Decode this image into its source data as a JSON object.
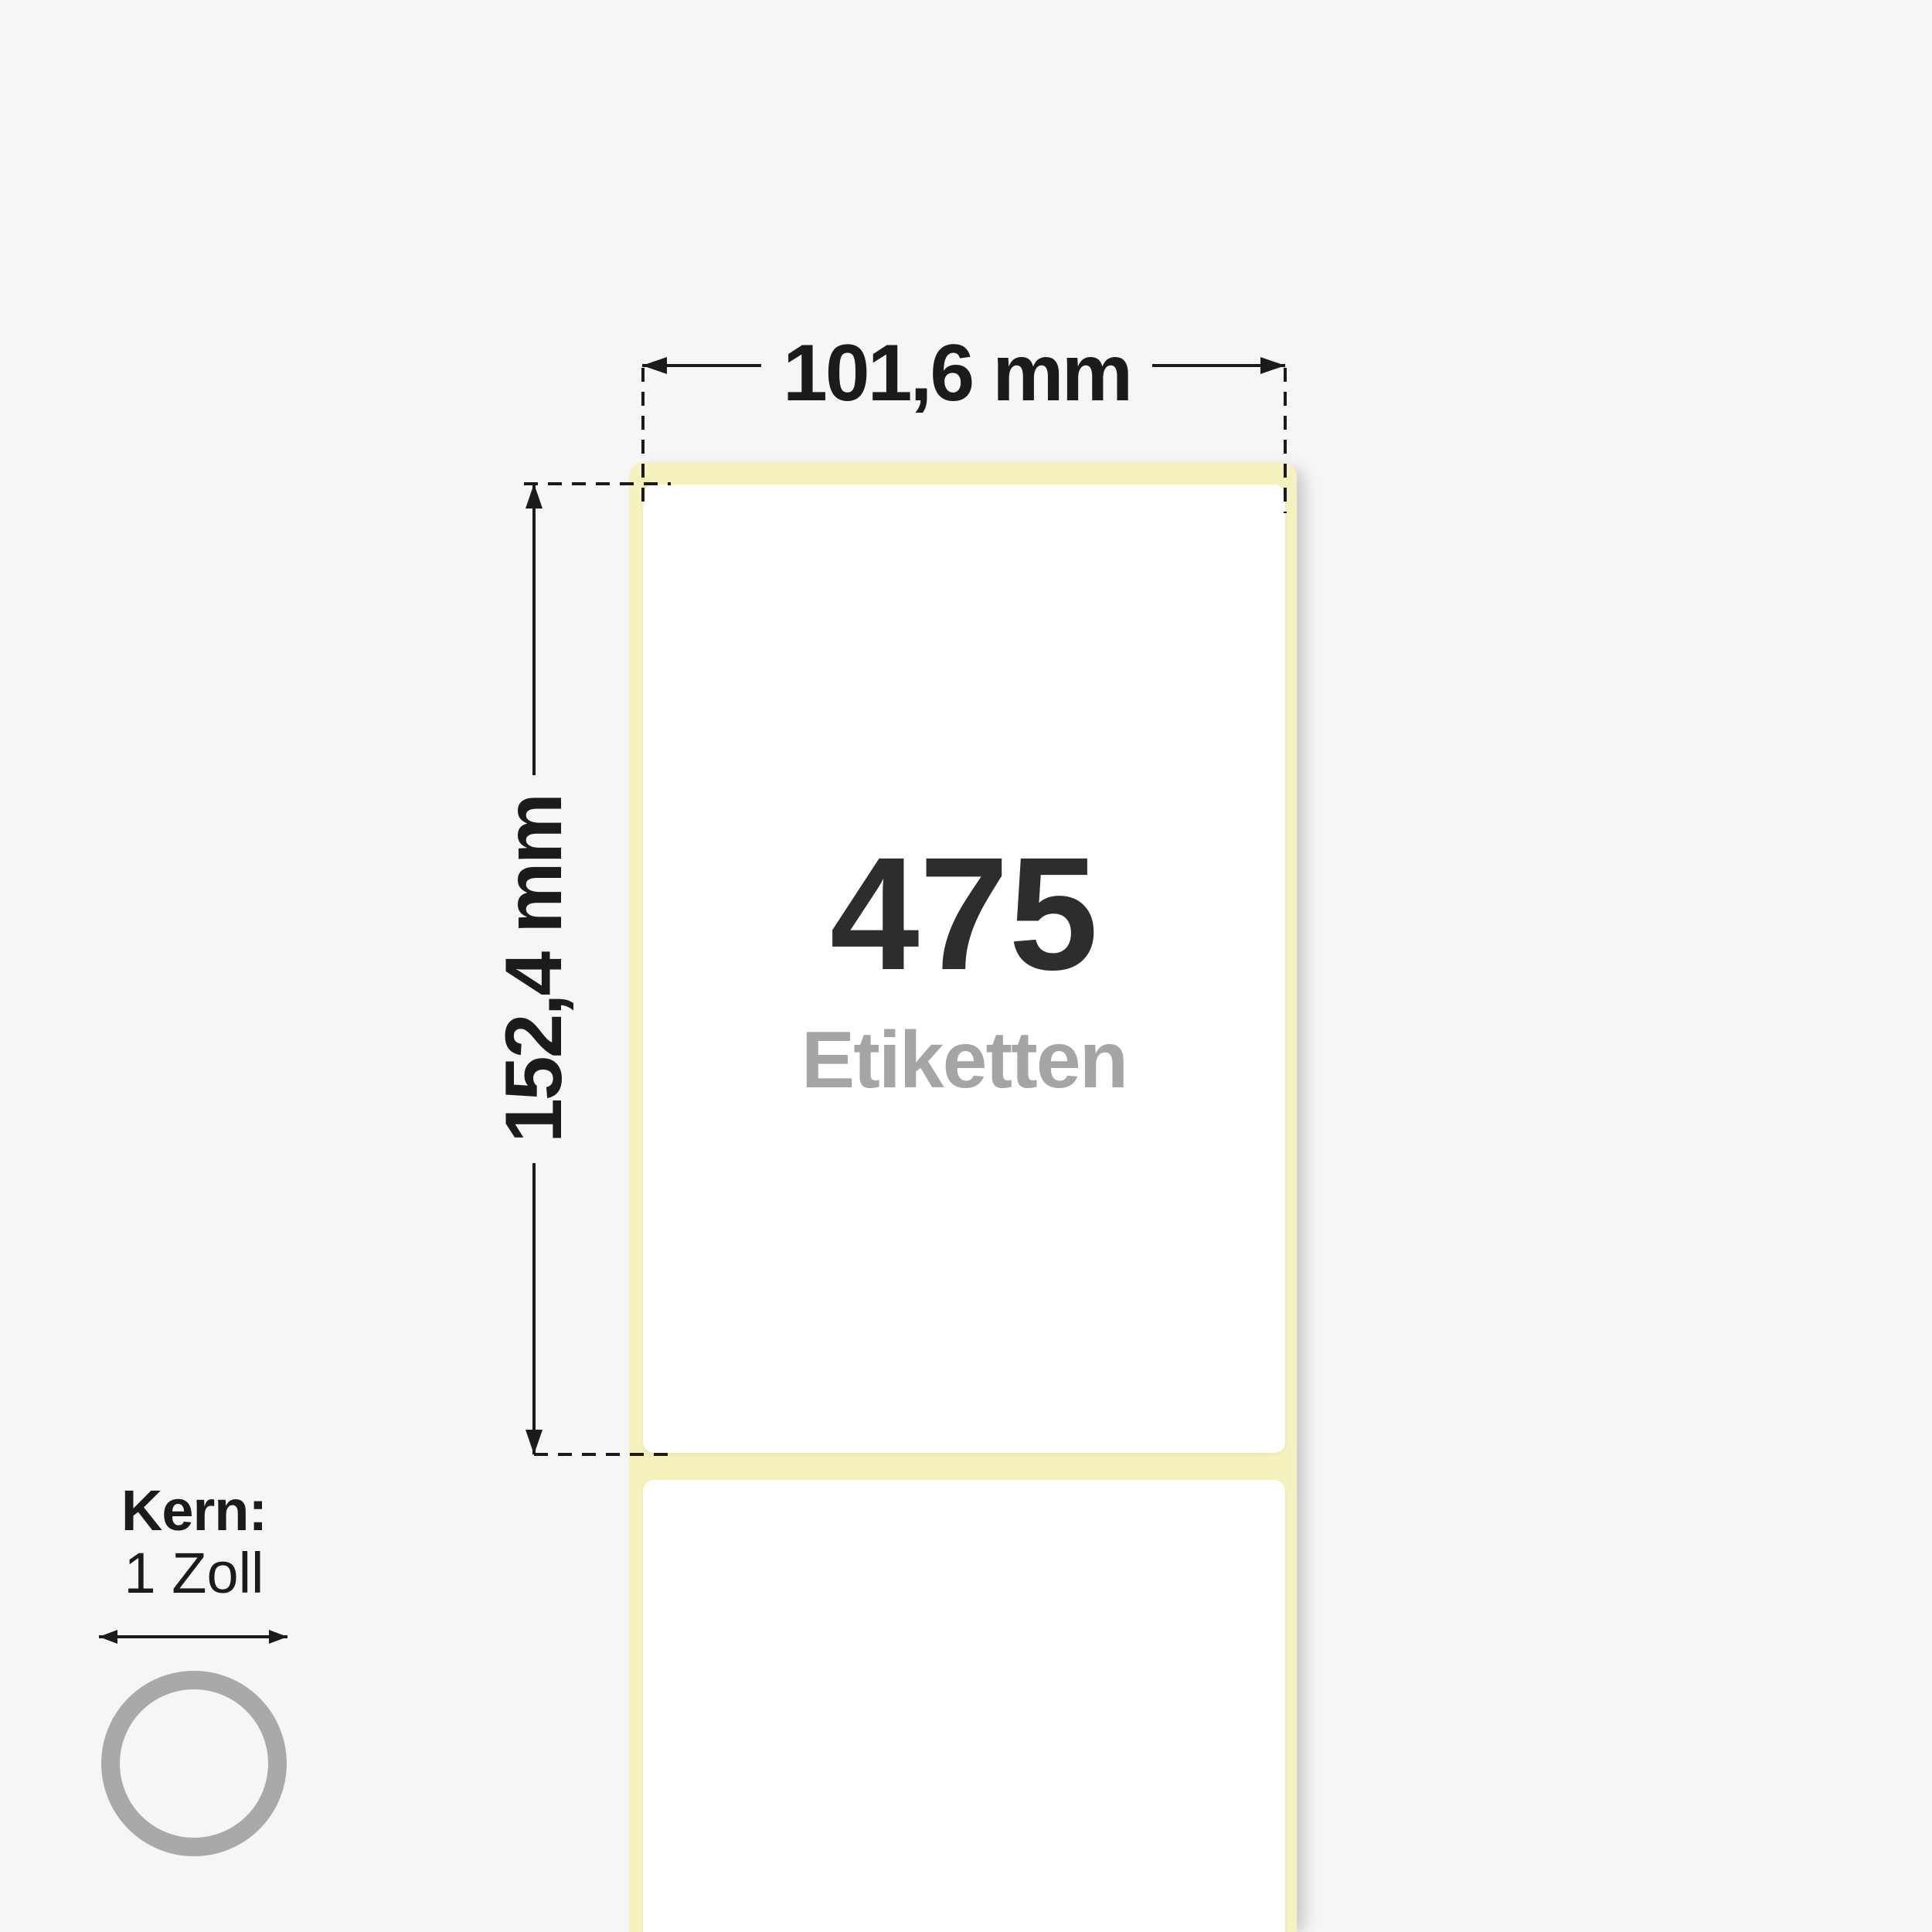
{
  "diagram": {
    "width_dimension": {
      "value": "101,6 mm"
    },
    "height_dimension": {
      "value": "152,4 mm"
    },
    "roll": {
      "count": "475",
      "count_unit": "Etiketten"
    },
    "core": {
      "label": "Kern:",
      "size": "1 Zoll"
    }
  },
  "colors": {
    "bg": "#f6f6f7",
    "liner": "#f5f2bf",
    "label": "#ffffff",
    "ink": "#1b1b1b",
    "count-ink": "#2d2d2d",
    "unit-ink": "#a5a5a5",
    "ring": "#a9a9a9"
  }
}
